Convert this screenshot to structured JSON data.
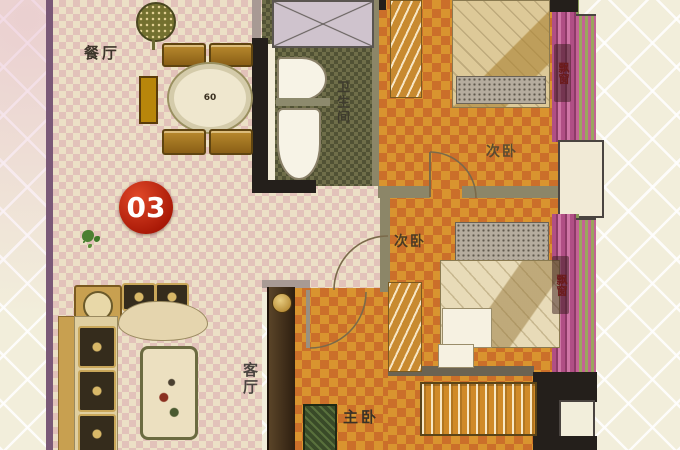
{
  "badge": {
    "number": "03"
  },
  "labels": {
    "dining": "餐厅",
    "living": "客厅",
    "bathroom": "卫生间",
    "bedroom_top": "次卧",
    "bedroom_mid": "次卧",
    "master": "主卧",
    "bay_window_top": "飘窗",
    "bay_window_mid": "飘窗"
  },
  "table_marking": "60",
  "colors": {
    "badge_red": "#bf1d0c",
    "bedroom_floor_orange": "#d9942f",
    "hall_floor_cream": "#ece0c6",
    "bathroom_floor_olive": "#6f6e49",
    "wall_black": "#241f1b",
    "wall_magenta": "#b04f85",
    "background_cream": "#f2eedb",
    "wood_brown": "#b8872b"
  }
}
